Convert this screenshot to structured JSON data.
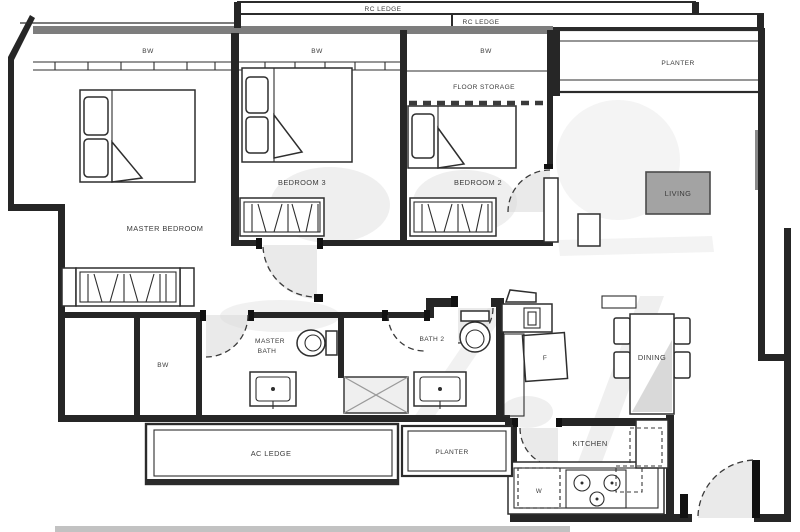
{
  "labels": {
    "rc_ledge_1": "RC LEDGE",
    "rc_ledge_2": "RC LEDGE",
    "bw_master": "BW",
    "bw_bed3": "BW",
    "bw_bed2": "BW",
    "bw_left": "BW",
    "planter_top": "PLANTER",
    "floor_storage": "FLOOR STORAGE",
    "bedroom_3": "BEDROOM 3",
    "bedroom_2": "BEDROOM 2",
    "living": "LIVING",
    "master_bedroom": "MASTER BEDROOM",
    "master_bath_1": "MASTER",
    "master_bath_2": "BATH",
    "bath_2": "BATH 2",
    "dining": "DINING",
    "fridge": "F",
    "washer": "W",
    "kitchen": "KITCHEN",
    "ac_ledge": "AC LEDGE",
    "planter_bottom": "PLANTER"
  },
  "colors": {
    "wall": "#262626",
    "window_bar": "#7d7d7d",
    "shading": "#d8d8d8",
    "living_badge": "#a3a3a3",
    "paper": "#ffffff"
  }
}
